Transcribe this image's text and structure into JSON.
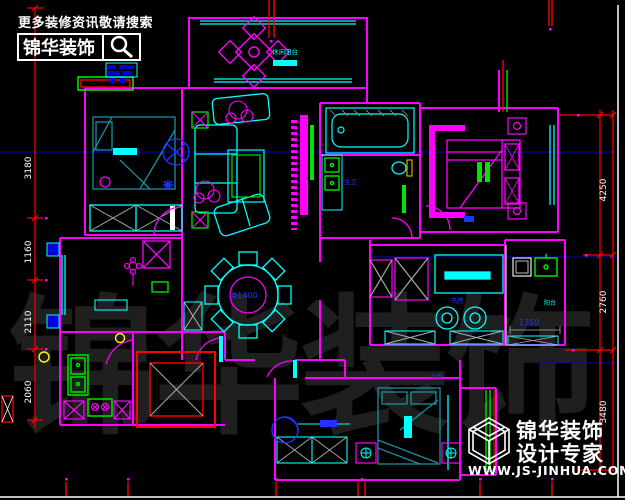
{
  "header": {
    "slogan": "更多装修资讯敬请搜索",
    "brand": "锦华装饰"
  },
  "watermark": "锦华装饰",
  "branding": {
    "name": "锦华装饰",
    "tagline": "设计专家",
    "website": "WWW.JS-JINHUA.COM"
  },
  "dimensions": {
    "left": [
      "3180",
      "1160",
      "2110",
      "2060"
    ],
    "right": [
      "4250",
      "2760",
      "3480"
    ],
    "table_diameter": "Φ1400",
    "closet_width": "1350"
  },
  "labels": {
    "balcony_top": "休闲阳台",
    "study": "书房",
    "balcony_right": "阳台",
    "bathroom": "主卫",
    "bedroom_bottom": "主卧"
  },
  "colors": {
    "wall": "#ff00ff",
    "furniture": "#00ffff",
    "bed": "#1a8fa0",
    "dimension": "#ff0000",
    "dim_text": "#ffffff",
    "annotation": "#2233ff",
    "fixture": "#00e400",
    "accent_yellow": "#ffff00",
    "watermark": "#1f1f1f"
  }
}
